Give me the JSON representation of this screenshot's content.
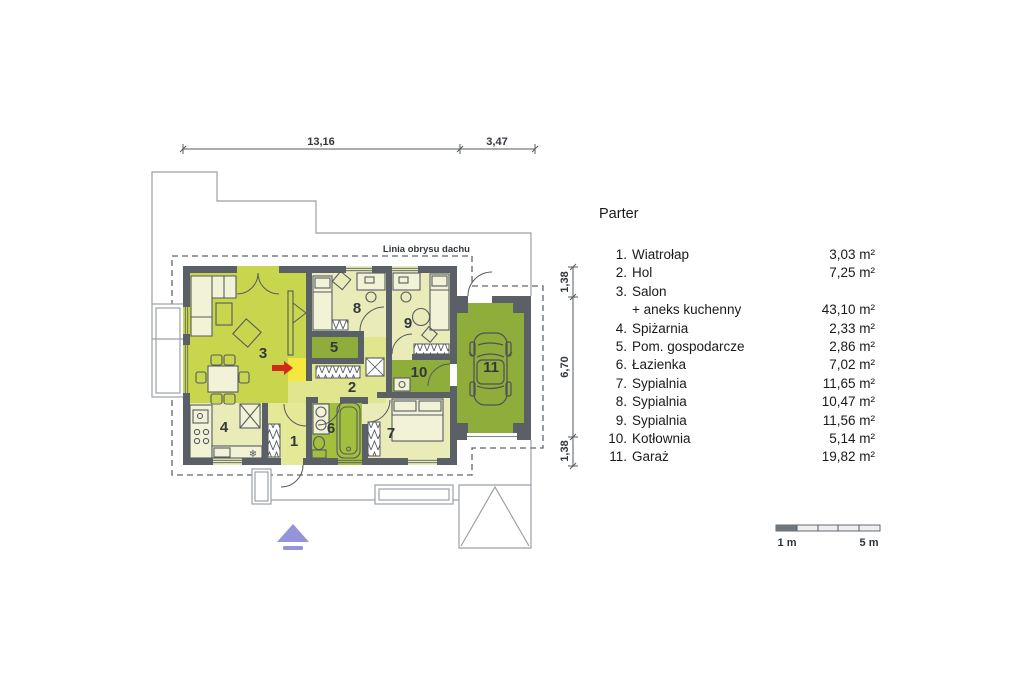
{
  "plan": {
    "roof_outline_label": "Linia obrysu dachu",
    "room_numbers": [
      "1",
      "2",
      "3",
      "4",
      "5",
      "6",
      "7",
      "8",
      "9",
      "10",
      "11"
    ],
    "dimensions": {
      "top": [
        "13,16",
        "3,47"
      ],
      "right": [
        "1,38",
        "6,70",
        "1,38"
      ]
    },
    "scale_bar": {
      "start_label": "1 m",
      "end_label": "5 m"
    },
    "icons": [
      "car-top-view",
      "fireplace",
      "freezer-snowflake",
      "entrance-arrow"
    ]
  },
  "legend": {
    "title": "Parter",
    "items": [
      {
        "num": "1.",
        "name": "Wiatrołap",
        "area": "3,03 m²"
      },
      {
        "num": "2.",
        "name": "Hol",
        "area": "7,25 m²"
      },
      {
        "num": "3.",
        "name": "Salon",
        "area": ""
      },
      {
        "num": "",
        "name": "+ aneks kuchenny",
        "area": "43,10 m²"
      },
      {
        "num": "4.",
        "name": "Spiżarnia",
        "area": "2,33 m²"
      },
      {
        "num": "5.",
        "name": "Pom. gospodarcze",
        "area": "2,86 m²"
      },
      {
        "num": "6.",
        "name": "Łazienka",
        "area": "7,02 m²"
      },
      {
        "num": "7.",
        "name": "Sypialnia",
        "area": "11,65 m²"
      },
      {
        "num": "8.",
        "name": "Sypialnia",
        "area": "10,47 m²"
      },
      {
        "num": "9.",
        "name": "Sypialnia",
        "area": "11,56 m²"
      },
      {
        "num": "10.",
        "name": "Kotłownia",
        "area": "5,14 m²"
      },
      {
        "num": "11.",
        "name": "Garaż",
        "area": "19,82 m²"
      }
    ],
    "snowflake": "❄"
  },
  "colors": {
    "wall": "#5b6066",
    "pale": "#e9ecb8",
    "salon": "#c7d64d",
    "hol": "#dfe68e",
    "room1": "#e3e996",
    "green": "#8fad3a",
    "bath": "#a2bf3e",
    "fire": "#f5e73b",
    "red": "#d42a1a",
    "purple": "#9394d9",
    "line": "#565b61",
    "thin": "#9ba1a6",
    "dash": "#60666c",
    "text": "#33383d",
    "legend": "#1a1a1a",
    "bedfill": "#f2f3d6"
  }
}
